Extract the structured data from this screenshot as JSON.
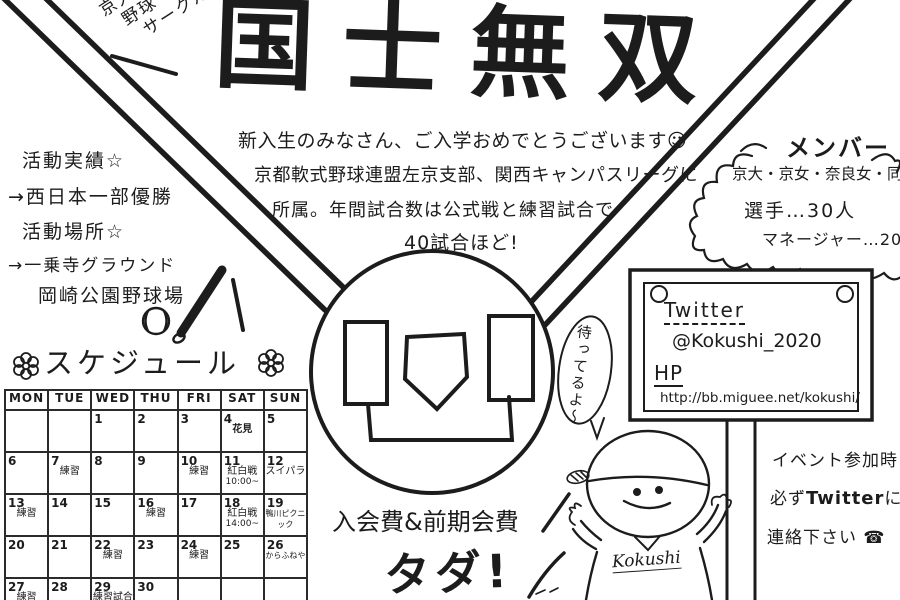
{
  "ink_color": "#1c1c1c",
  "club_label": {
    "lines": [
      "京大",
      "野球",
      "サークル"
    ]
  },
  "title": "国士無双",
  "greeting": {
    "line1": "新入生のみなさん、ご入学おめでとうございます☺",
    "line2": "京都軟式野球連盟左京支部、関西キャンパスリーグに",
    "line3": "所属。年間試合数は公式戦と練習試合で",
    "line4": "40試合ほど!"
  },
  "activities": {
    "results_label": "活動実績☆",
    "results_value": "→西日本一部優勝",
    "place_label": "活動場所☆",
    "place_value1": "→一乗寺グラウンド",
    "place_value2": "岡崎公園野球場"
  },
  "schedule": {
    "title": "スケジュール",
    "headers": [
      "MON",
      "TUE",
      "WED",
      "THU",
      "FRI",
      "SAT",
      "SUN"
    ],
    "weeks": [
      [
        {
          "d": ""
        },
        {
          "d": ""
        },
        {
          "d": "1"
        },
        {
          "d": "2"
        },
        {
          "d": "3"
        },
        {
          "d": "4",
          "note": "花見",
          "b": true
        },
        {
          "d": "5"
        }
      ],
      [
        {
          "d": "6"
        },
        {
          "d": "7",
          "note": "練習"
        },
        {
          "d": "8"
        },
        {
          "d": "9"
        },
        {
          "d": "10",
          "note": "練習"
        },
        {
          "d": "11",
          "note": "紅白戦",
          "note2": "10:00~"
        },
        {
          "d": "12",
          "note": "スイパラ"
        }
      ],
      [
        {
          "d": "13",
          "note": "練習"
        },
        {
          "d": "14"
        },
        {
          "d": "15"
        },
        {
          "d": "16",
          "note": "練習"
        },
        {
          "d": "17"
        },
        {
          "d": "18",
          "note": "紅白戦",
          "note2": "14:00~"
        },
        {
          "d": "19",
          "note": "鴨川ピクニック"
        }
      ],
      [
        {
          "d": "20"
        },
        {
          "d": "21"
        },
        {
          "d": "22",
          "note": "練習"
        },
        {
          "d": "23"
        },
        {
          "d": "24",
          "note": "練習"
        },
        {
          "d": "25"
        },
        {
          "d": "26",
          "note": "からふねや"
        }
      ],
      [
        {
          "d": "27",
          "note": "練習"
        },
        {
          "d": "28"
        },
        {
          "d": "29",
          "note": "練習試合"
        },
        {
          "d": "30"
        },
        {
          "d": ""
        },
        {
          "d": ""
        },
        {
          "d": ""
        }
      ]
    ]
  },
  "members": {
    "title": "メンバー",
    "schools": "京大・京女・奈良女・同女",
    "players": "選手…30人",
    "managers": "マネージャー…20人"
  },
  "sign": {
    "twitter_label": "Twitter",
    "twitter_handle": "@Kokushi_2020",
    "hp_label": "HP",
    "url": "http://bb.miguee.net/kokushi/"
  },
  "speech_bubble": "待ってるよ〜",
  "mascot_name": "Kokushi",
  "fee": {
    "line1": "入会費&前期会費",
    "line2": "タダ!"
  },
  "contact": {
    "line1": "イベント参加時",
    "line2_pre": "必ず",
    "line2_bold": "Twitter",
    "line2_post": "に",
    "line3": "連絡下さい",
    "phone_icon": "☎"
  }
}
